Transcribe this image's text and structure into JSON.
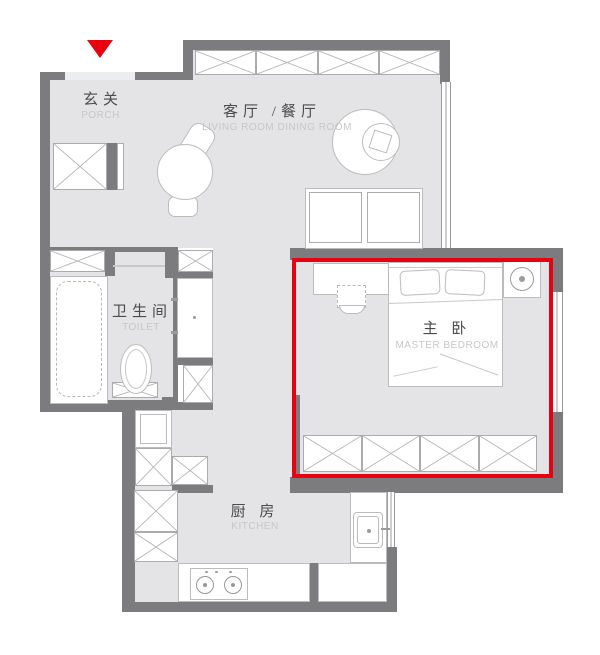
{
  "plan": {
    "type": "apartment-floor-plan",
    "highlighted_room": "master_bedroom",
    "colors": {
      "wall": "#7c7c7e",
      "floor": "#e4e4e6",
      "highlight_border": "#e60012",
      "entry_marker": "#e8000e",
      "label_cn": "#4b4b4d",
      "label_en": "#c7c7c9"
    },
    "rooms": {
      "porch": {
        "label_cn": "玄关",
        "label_en": "PORCH"
      },
      "living_dining": {
        "label_cn": "客厅 /餐厅",
        "label_en": "LIVING ROOM DINING ROOM"
      },
      "toilet": {
        "label_cn": "卫生间",
        "label_en": "TOILET"
      },
      "kitchen": {
        "label_cn": "厨 房",
        "label_en": "KITCHEN"
      },
      "master_bedroom": {
        "label_cn": "主 卧",
        "label_en": "MASTER BEDROOM"
      }
    }
  }
}
